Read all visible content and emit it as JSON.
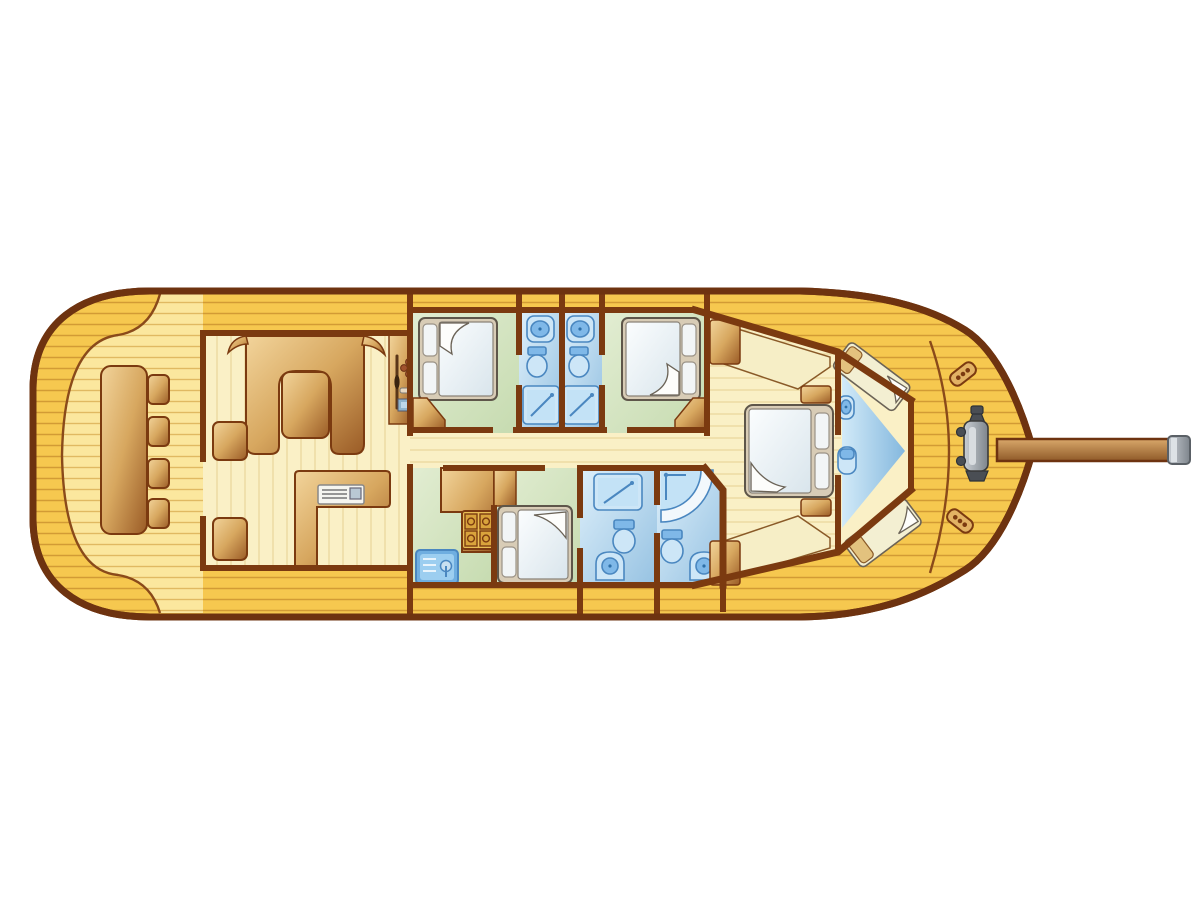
{
  "diagram": {
    "kind": "yacht-floor-plan",
    "view": "top-down deck plan, bow pointing right, no text labels",
    "rooms": [
      {
        "id": "aft-deck-cockpit",
        "label": "Aft deck cockpit",
        "floor": "light wood planks",
        "furniture": [
          "rectangular table",
          "four stools",
          "companionway steps"
        ]
      },
      {
        "id": "salon",
        "label": "Salon",
        "floor": "pale wood planks",
        "furniture": [
          "U-shaped sofa",
          "salon table",
          "helm console with wheel and instruments",
          "L-shaped counter with appliance"
        ]
      },
      {
        "id": "guest-cabin-port",
        "label": "Guest cabin (forward port side, top left)",
        "floor": "green",
        "furniture": [
          "double bed with two pillows",
          "corner wardrobe"
        ]
      },
      {
        "id": "bathroom-port-1",
        "label": "Ensuite bathroom 1 (top middle)",
        "floor": "blue",
        "fixtures": [
          "washbasin",
          "toilet",
          "shower tray"
        ]
      },
      {
        "id": "bathroom-port-2",
        "label": "Ensuite bathroom 2 (top middle)",
        "floor": "blue",
        "fixtures": [
          "washbasin",
          "toilet",
          "shower tray"
        ]
      },
      {
        "id": "guest-cabin-starboard",
        "label": "Guest cabin (forward starboard of top pair)",
        "floor": "green",
        "furniture": [
          "double bed with two pillows",
          "corner wardrobe"
        ]
      },
      {
        "id": "galley",
        "label": "Galley (lower middle)",
        "floor": "green",
        "fixtures": [
          "counter",
          "four-burner stove",
          "sink with faucet"
        ]
      },
      {
        "id": "guest-cabin-lower",
        "label": "Guest cabin (lower middle)",
        "floor": "green",
        "furniture": [
          "double bed with two pillows",
          "wardrobe"
        ]
      },
      {
        "id": "bathroom-lower-1",
        "label": "Bathroom (lower, square shower)",
        "floor": "blue",
        "fixtures": [
          "shower tray",
          "toilet",
          "washbasin"
        ]
      },
      {
        "id": "bathroom-lower-2",
        "label": "Bathroom (lower, corner shower)",
        "floor": "blue",
        "fixtures": [
          "corner shower",
          "toilet",
          "washbasin"
        ]
      },
      {
        "id": "master-cabin",
        "label": "Master cabin (forward)",
        "floor": "pale wood planks",
        "furniture": [
          "double bed with two pillows",
          "two side benches",
          "two nightstands"
        ]
      },
      {
        "id": "bow-cabin",
        "label": "Bow cabin",
        "floor": "blue wedge",
        "furniture": [
          "two V-berths",
          "washbasin",
          "toilet"
        ]
      },
      {
        "id": "bow-deck",
        "label": "Bow deck",
        "fixtures": [
          "anchor windlass",
          "two mooring cleats",
          "bowsprit"
        ]
      }
    ],
    "inventory": {
      "double_beds": 4,
      "single_v_berths": 2,
      "bathrooms": 4,
      "toilets": 5,
      "washbasins": 5,
      "showers": 4,
      "stove_burners": 4,
      "cockpit_stools": 4,
      "mooring_cleats": 2
    }
  },
  "colors": {
    "background": "#FFFFFF",
    "hull_deck": "#F6C84F",
    "deck_plank_line": "#C9902E",
    "hull_outline": "#6E3310",
    "wall": "#7B3A10",
    "cockpit_deck": "#FBE79E",
    "cockpit_plank_line": "#DDB45C",
    "interior_floor": "#FAF0C6",
    "interior_plank_line": "#E9D69C",
    "cabin_floor": "#D8E6C4",
    "bath_light": "#DDEFFA",
    "bath_dark": "#96C2E2",
    "fixture_blue": "#7FB8E8",
    "fixture_stroke": "#4A87C0",
    "wood_light": "#F2D49B",
    "wood_mid": "#D7A75F",
    "wood_dark": "#9A5B26",
    "bench_cream": "#F6EEC6",
    "bed_frame": "#D8CCB6",
    "bed_frame_stroke": "#5E564A",
    "mattress": "#FBFDFE",
    "mattress_shade": "#D9E5EC",
    "pillow": "#F2F5F6",
    "berth_mattress": "#F3EFD2",
    "berth_pillow": "#E3C27E",
    "metal_light": "#C9CED4",
    "metal_dark": "#7E858C"
  }
}
